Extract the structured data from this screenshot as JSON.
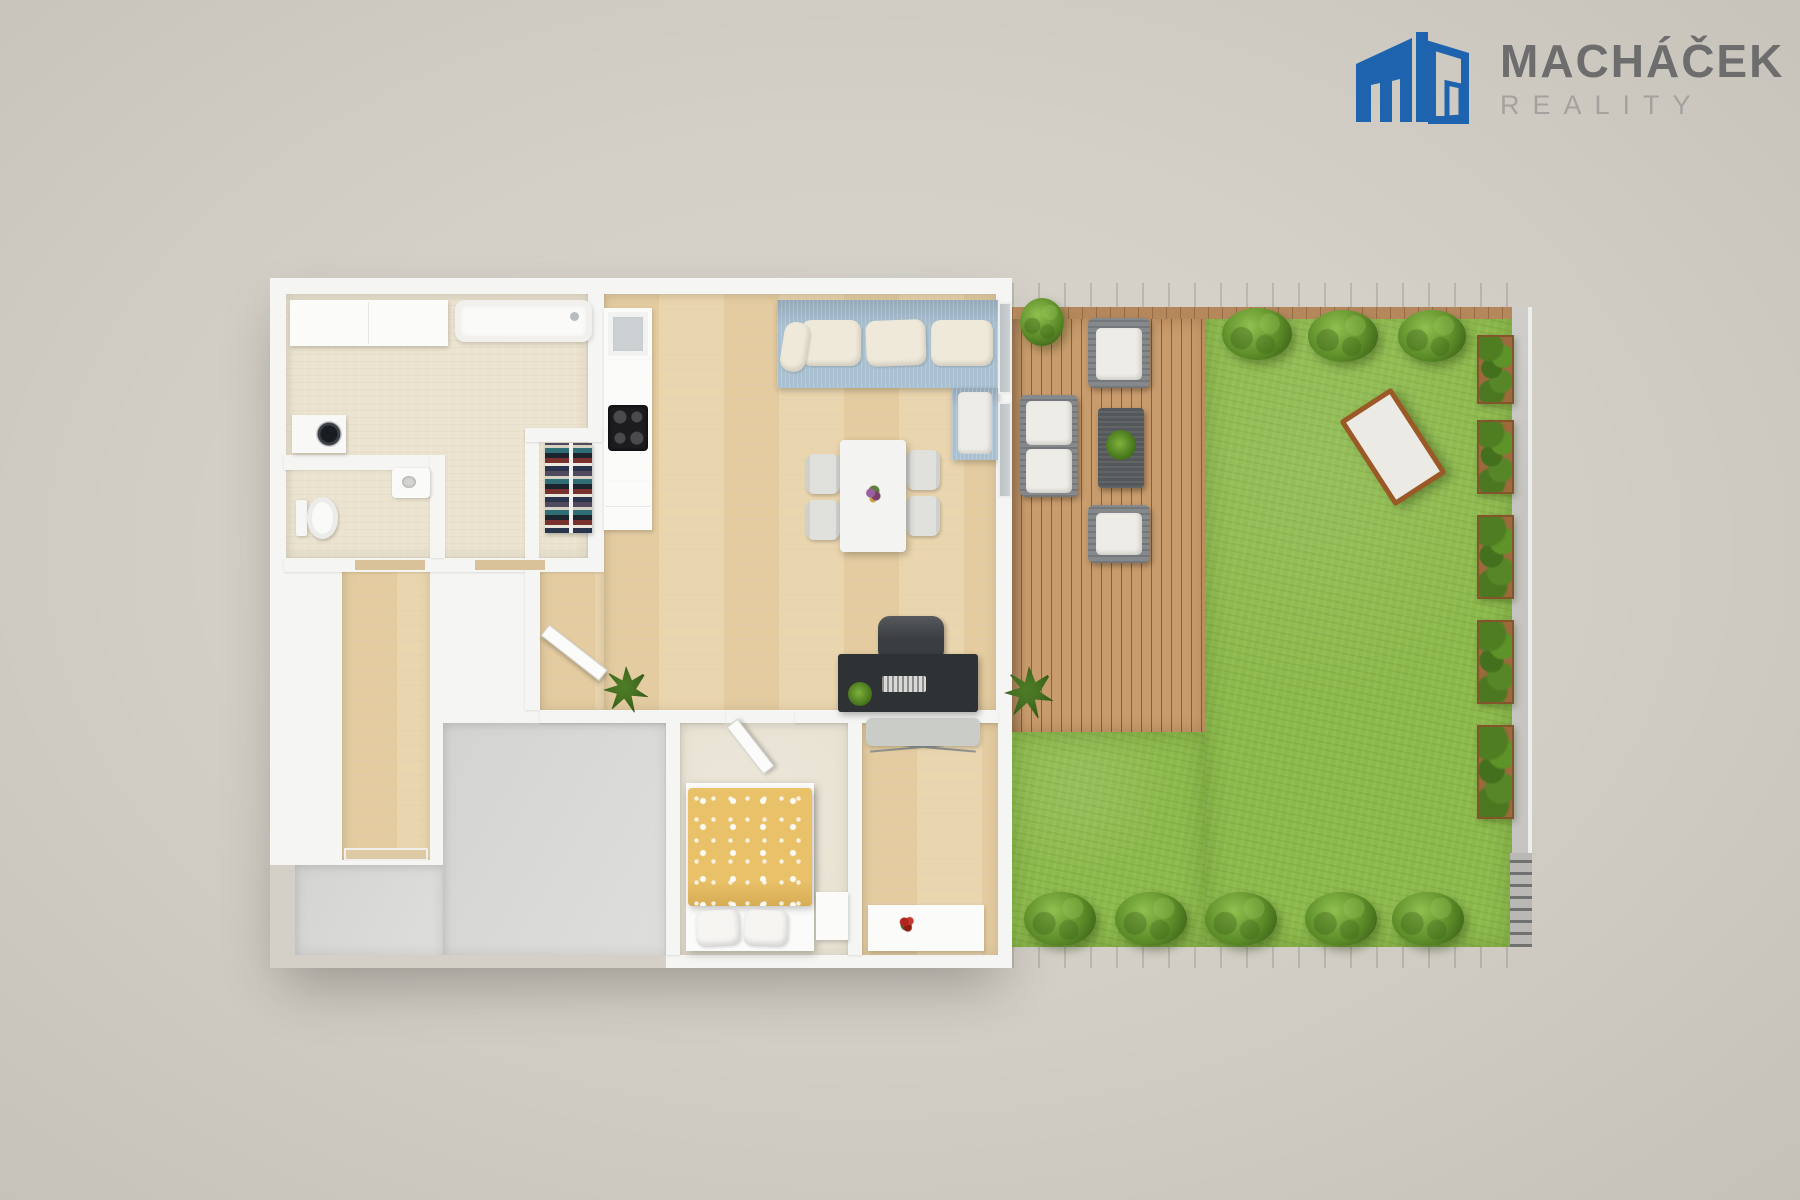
{
  "logo": {
    "title": "MACHÁČEK",
    "subtitle": "REALITY",
    "icon": "building-icon"
  },
  "colors": {
    "background": "#d4d0c7",
    "brand-blue": "#1d63ae",
    "logo-title": "#6d6d6d",
    "logo-subtitle": "#a3a29e",
    "wall": "#f5f5f3",
    "wood-floor": "#e9d3a9",
    "tile-floor": "#ebe3cf",
    "carpet-floor": "#e9e3d4",
    "slab": "#dcdcda",
    "grass": "#8cb94b",
    "deck": "#c2946a",
    "fence": "#73281a",
    "sofa-blue": "#a9c0d1",
    "cushion-cream": "#efe9da",
    "duvet-yellow": "#e9c168",
    "desk-dark": "#2f3235",
    "outdoor-gray": "#85898c"
  }
}
